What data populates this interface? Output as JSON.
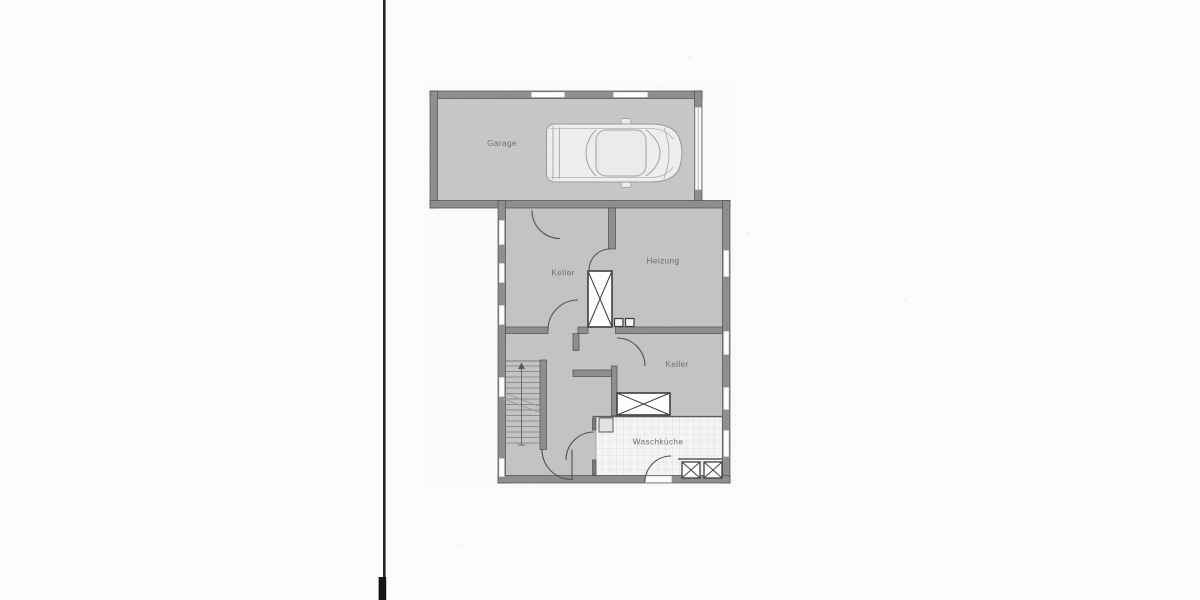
{
  "floor_plan": {
    "document_kind": "scanned basement floor plan",
    "rooms": [
      {
        "id": "garage",
        "label": "Garage"
      },
      {
        "id": "keller_upper",
        "label": "Keller"
      },
      {
        "id": "heizung",
        "label": "Heizung"
      },
      {
        "id": "keller_lower",
        "label": "Keller"
      },
      {
        "id": "waschkueche",
        "label": "Waschküche"
      }
    ],
    "symbols": [
      {
        "name": "car-top-view",
        "count": 1
      },
      {
        "name": "staircase-with-arrow",
        "count": 1
      },
      {
        "name": "chimney-crossed-rect",
        "count": 2
      },
      {
        "name": "drain-crossed-square",
        "count": 2
      },
      {
        "name": "small-shaft-square",
        "count": 2
      },
      {
        "name": "door-swing-arc",
        "count": 7
      },
      {
        "name": "window-opening",
        "count": 11
      },
      {
        "name": "garage-door",
        "count": 1
      }
    ],
    "colors": {
      "paper": "#fcfcfc",
      "room_fill": "#c3c3c3",
      "garage_fill": "#c7c7c7",
      "wall_fill": "#8d8d8d",
      "line": "#4f4f4f",
      "tile_floor": "#f6f6f5",
      "scan_line": "#262626"
    }
  }
}
